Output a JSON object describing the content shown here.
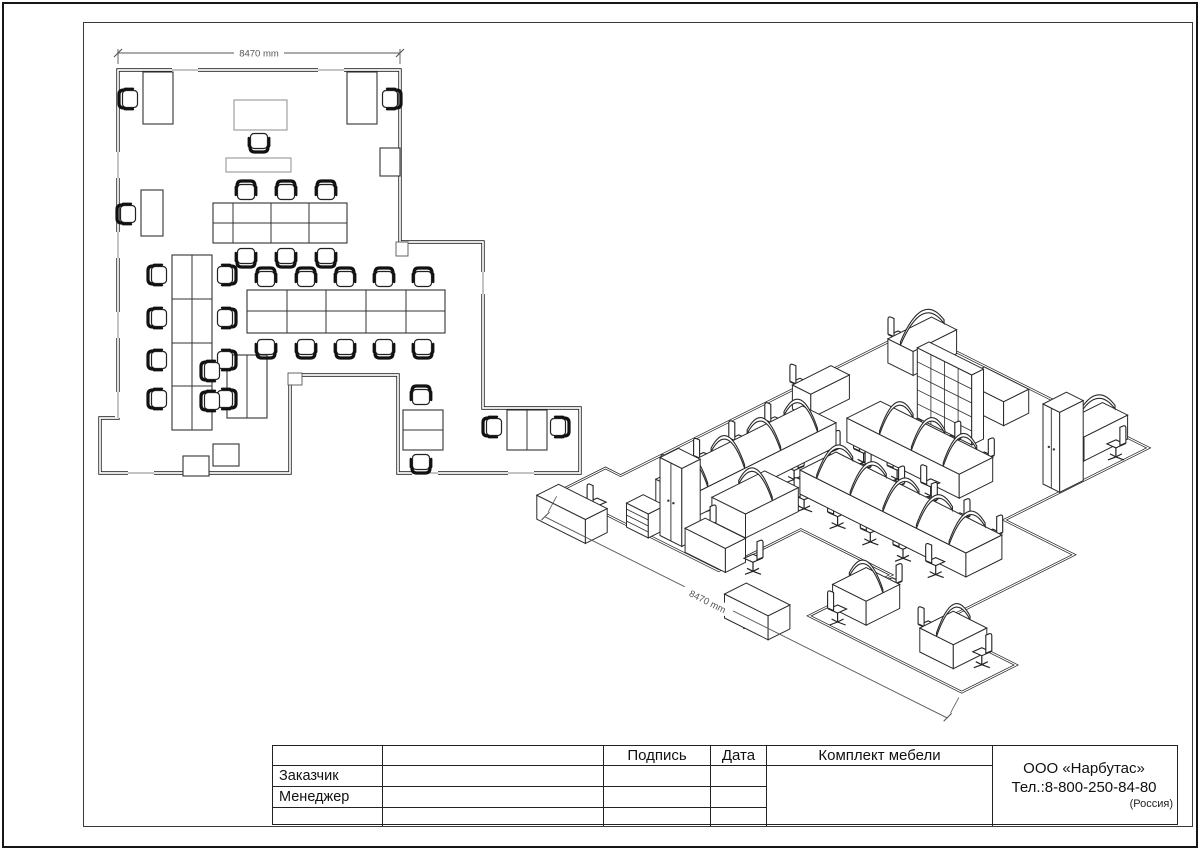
{
  "title_block": {
    "headers": {
      "signature": "Подпись",
      "date": "Дата",
      "furniture_set": "Комплект мебели"
    },
    "rows": [
      {
        "label": "Заказчик"
      },
      {
        "label": "Менеджер"
      }
    ],
    "company": {
      "name": "ООО «Нарбутас»",
      "phone": "Тел.:8-800-250-84-80",
      "country": "(Россия)"
    }
  },
  "drawing": {
    "line_color": "#222222",
    "dim_color": "#555555",
    "plan": {
      "dimension_label": "8470 mm",
      "outline": [
        [
          118,
          70
        ],
        [
          400,
          70
        ],
        [
          400,
          242
        ],
        [
          483,
          242
        ],
        [
          483,
          408
        ],
        [
          580,
          408
        ],
        [
          580,
          473
        ],
        [
          398,
          473
        ],
        [
          398,
          375
        ],
        [
          290,
          375
        ],
        [
          290,
          473
        ],
        [
          100,
          473
        ],
        [
          100,
          418
        ],
        [
          118,
          418
        ]
      ],
      "windows": [
        [
          172,
          67,
          26,
          6
        ],
        [
          318,
          67,
          26,
          6
        ],
        [
          115,
          152,
          6,
          26
        ],
        [
          115,
          232,
          6,
          26
        ],
        [
          115,
          312,
          6,
          26
        ],
        [
          115,
          392,
          6,
          26
        ],
        [
          128,
          470,
          26,
          6
        ],
        [
          412,
          470,
          26,
          6
        ],
        [
          508,
          470,
          26,
          6
        ],
        [
          480,
          272,
          6,
          22
        ]
      ],
      "columns": [
        [
          396,
          242,
          12,
          14
        ],
        [
          288,
          373,
          14,
          12
        ]
      ],
      "desks": [
        {
          "x": 143,
          "y": 72,
          "w": 30,
          "h": 52,
          "arcs": {
            "along": "y",
            "at": [
              158
            ]
          }
        },
        {
          "x": 347,
          "y": 72,
          "w": 30,
          "h": 52,
          "arcs": {
            "along": "y",
            "at": [
              362
            ]
          }
        },
        {
          "x": 234,
          "y": 100,
          "w": 53,
          "h": 30,
          "light": true
        },
        {
          "x": 226,
          "y": 158,
          "w": 65,
          "h": 14,
          "light": true,
          "kind": "shelving",
          "tall": 70
        },
        {
          "x": 380,
          "y": 148,
          "w": 20,
          "h": 28,
          "kind": "wardrobe",
          "tall": 80
        },
        {
          "x": 141,
          "y": 190,
          "w": 22,
          "h": 46
        },
        {
          "x": 213,
          "y": 203,
          "w": 134,
          "h": 40,
          "vx": [
            233,
            271,
            309
          ],
          "hy": [
            223
          ],
          "arcs": {
            "along": "y",
            "at": [
              252,
              290,
              328
            ]
          }
        },
        {
          "x": 172,
          "y": 255,
          "w": 40,
          "h": 175,
          "vx": [
            192
          ],
          "hy": [
            299,
            343,
            386
          ],
          "arcs": {
            "along": "x",
            "at": [
              277,
              321,
              364,
              408
            ]
          }
        },
        {
          "x": 247,
          "y": 290,
          "w": 198,
          "h": 43,
          "vx": [
            287,
            326,
            366,
            406
          ],
          "hy": [
            311
          ],
          "arcs": {
            "along": "y",
            "at": [
              267,
              307,
              346,
              386,
              425
            ]
          }
        },
        {
          "x": 227,
          "y": 355,
          "w": 40,
          "h": 63,
          "vx": [
            247
          ],
          "arcs": {
            "along": "x",
            "at": [
              386
            ]
          }
        },
        {
          "x": 213,
          "y": 444,
          "w": 26,
          "h": 22,
          "kind": "wardrobe",
          "tall": 78
        },
        {
          "x": 183,
          "y": 456,
          "w": 26,
          "h": 20,
          "kind": "pedestal"
        },
        {
          "x": 403,
          "y": 410,
          "w": 40,
          "h": 40,
          "hy": [
            430
          ],
          "arcs": {
            "along": "x",
            "at": [
              430
            ]
          }
        },
        {
          "x": 507,
          "y": 410,
          "w": 40,
          "h": 40,
          "vx": [
            527
          ],
          "arcs": {
            "along": "y",
            "at": [
              527
            ]
          }
        }
      ],
      "chairs": [
        [
          130,
          99,
          -90
        ],
        [
          390,
          99,
          90
        ],
        [
          259,
          141,
          180
        ],
        [
          128,
          214,
          -90
        ],
        [
          246,
          192,
          0
        ],
        [
          286,
          192,
          0
        ],
        [
          326,
          192,
          0
        ],
        [
          246,
          256,
          180
        ],
        [
          286,
          256,
          180
        ],
        [
          326,
          256,
          180
        ],
        [
          159,
          275,
          -90
        ],
        [
          159,
          318,
          -90
        ],
        [
          159,
          360,
          -90
        ],
        [
          159,
          399,
          -90
        ],
        [
          225,
          275,
          90
        ],
        [
          225,
          318,
          90
        ],
        [
          225,
          360,
          90
        ],
        [
          225,
          399,
          90
        ],
        [
          266,
          279,
          0
        ],
        [
          306,
          279,
          0
        ],
        [
          345,
          279,
          0
        ],
        [
          384,
          279,
          0
        ],
        [
          423,
          279,
          0
        ],
        [
          266,
          347,
          180
        ],
        [
          306,
          347,
          180
        ],
        [
          345,
          347,
          180
        ],
        [
          384,
          347,
          180
        ],
        [
          423,
          347,
          180
        ],
        [
          212,
          371,
          -90
        ],
        [
          212,
          401,
          -90
        ],
        [
          421,
          397,
          0
        ],
        [
          421,
          462,
          180
        ],
        [
          494,
          427,
          -90
        ],
        [
          558,
          427,
          90
        ]
      ]
    },
    "iso": {
      "dimension_label": "8470 mm",
      "extra_desks": [
        {
          "x": 120,
          "y": 494,
          "w": 58,
          "h": 26
        },
        {
          "x": 248,
          "y": 447,
          "w": 48,
          "h": 24
        },
        {
          "x": 350,
          "y": 500,
          "w": 52,
          "h": 26
        }
      ],
      "extra_chairs": [
        [
          150,
          478,
          -90
        ],
        [
          240,
          438,
          0
        ],
        [
          310,
          452,
          90
        ],
        [
          374,
          518,
          90
        ]
      ]
    }
  }
}
